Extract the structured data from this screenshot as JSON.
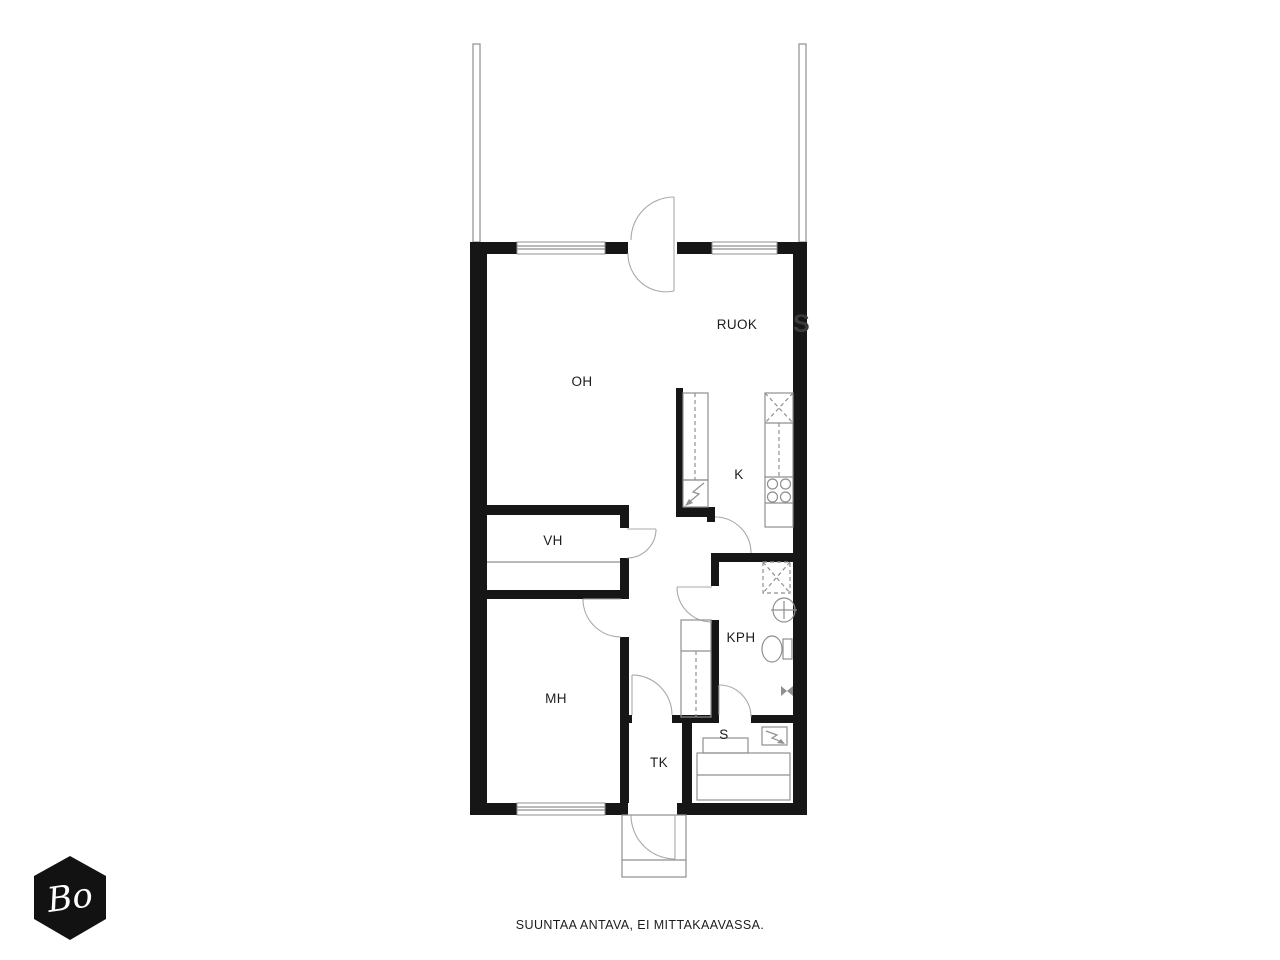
{
  "labels": {
    "oh": "OH",
    "ruok": "RUOK",
    "k": "K",
    "vh": "VH",
    "kph": "KPH",
    "mh": "MH",
    "tk": "TK",
    "s": "S"
  },
  "caption": "SUUNTAA ANTAVA, EI MITTAKAAVASSA.",
  "logo": {
    "text": "Bo"
  },
  "watermark": "S",
  "colors": {
    "wall": "#161616",
    "line": "#8f8f8f",
    "line_light": "#a8a8a8",
    "text": "#1c1c1c",
    "logo_bg": "#121212",
    "page_bg": "#ffffff"
  }
}
